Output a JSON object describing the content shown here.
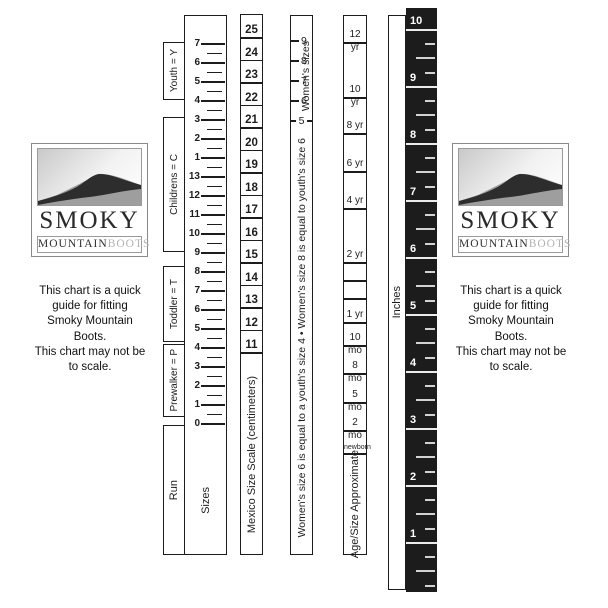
{
  "logo": {
    "smoky": "SMOKY",
    "mountain": "MOUNTAIN",
    "boots": "BOOTS"
  },
  "note": {
    "lines": [
      "This chart is a quick",
      "guide for fitting",
      "Smoky Mountain",
      "Boots.",
      "This chart may not be",
      "to scale."
    ]
  },
  "sizes_ruler": {
    "run_label": "Run",
    "sizes_label": "Sizes",
    "numbers": [
      "7",
      "6",
      "5",
      "4",
      "3",
      "2",
      "1",
      "13",
      "12",
      "11",
      "10",
      "9",
      "8",
      "7",
      "6",
      "5",
      "4",
      "3",
      "2",
      "1",
      "0"
    ],
    "first_y": 28,
    "step": 19,
    "brackets": [
      {
        "id": "youth",
        "label": "Youth = Y",
        "top": 42,
        "height": 58
      },
      {
        "id": "childrens",
        "label": "Childrens = C",
        "top": 117,
        "height": 135
      },
      {
        "id": "toddler",
        "label": "Toddler = T",
        "top": 266,
        "height": 76
      },
      {
        "id": "prewalker",
        "label": "Prewalker = P",
        "top": 344,
        "height": 73
      }
    ]
  },
  "mexico_scale": {
    "label": "Mexico Size Scale (centimeters)",
    "numbers": [
      "25",
      "24",
      "23",
      "22",
      "21",
      "20",
      "19",
      "18",
      "17",
      "16",
      "15",
      "14",
      "13",
      "12",
      "11"
    ],
    "first_y": 15,
    "step": 22.5
  },
  "womens": {
    "axis_label": "Women's sizes",
    "numbers": [
      "9",
      "8",
      "7",
      "6",
      "5"
    ],
    "first_y": 25,
    "step": 20,
    "equivalence_note": "Women's size 6 is equal to a youth's size 4 • Women's size 8 is equal to youth's size 6"
  },
  "age_scale": {
    "label": "Age/Size Approximate",
    "cells": [
      {
        "label": "12 yr",
        "line_y": 27
      },
      {
        "label": "10 yr",
        "line_y": 82
      },
      {
        "label": "8 yr",
        "line_y": 118
      },
      {
        "label": "6 yr",
        "line_y": 156
      },
      {
        "label": "4 yr",
        "line_y": 193
      },
      {
        "label": "2 yr",
        "line_y": 247
      },
      {
        "label": "",
        "line_y": 265
      },
      {
        "label": "",
        "line_y": 283
      },
      {
        "label": "1 yr",
        "line_y": 307
      },
      {
        "label": "10 mo",
        "line_y": 330
      },
      {
        "label": "8 mo",
        "line_y": 358
      },
      {
        "label": "5 mo",
        "line_y": 387
      },
      {
        "label": "2 mo",
        "line_y": 415
      },
      {
        "label": "newborn",
        "line_y": 438
      }
    ]
  },
  "inches_ruler": {
    "label": "Inches",
    "numbers": [
      "10",
      "9",
      "8",
      "7",
      "6",
      "5",
      "4",
      "3",
      "2",
      "1"
    ],
    "first_line_y": 22,
    "step": 57,
    "colors": {
      "bg": "#1c1c1c",
      "line": "#ececec",
      "tick": "#d2d2d2",
      "text": "#ffffff"
    }
  }
}
